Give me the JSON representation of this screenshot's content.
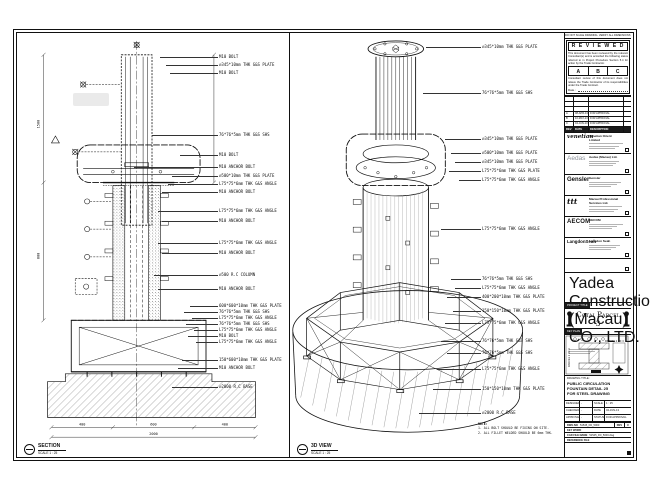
{
  "sheet": {
    "note_strip": "DO NOT SCALE DRAWING. VERIFY ALL DIMENSIONS ON SITE."
  },
  "section_view": {
    "title": "SECTION",
    "scale": "SCALE 1 : 25",
    "labels": [
      "M10 BOLT",
      "⌀345*10mm THK G&S PLATE",
      "M10 BOLT",
      "76*76*5mm THK G&S SHS",
      "M10 BOLT",
      "M10 ANCHOR BOLT",
      "⌀500*10mm THK G&S PLATE",
      "L75*75*6mm THK G&S ANGLE",
      "M10 ANCHOR BOLT",
      "L75*75*6mm THK G&S ANGLE",
      "M10 ANCHOR BOLT",
      "L75*75*6mm THK G&S ANGLE",
      "M10 ANCHOR BOLT",
      "⌀500 R.C COLUMN",
      "M10 ANCHOR BOLT",
      "600*600*10mm THK G&S PLATE",
      "76*76*5mm THK G&S SHS",
      "L75*75*6mm THK G&S ANGLE",
      "76*76*5mm THK G&S SHS",
      "L75*75*6mm THK G&S ANGLE",
      "M10 BOLT",
      "L75*75*6mm THK G&S ANGLE",
      "150*600*10mm THK G&S PLATE",
      "M10 ANCHOR BOLT",
      "⌀2000 R.C BASE"
    ],
    "dims": {
      "v1": "1500",
      "v2": "800",
      "b1": "400",
      "b2": "600",
      "b3": "400",
      "total": "2000"
    }
  },
  "iso_view": {
    "title": "3D VIEW",
    "scale": "SCALE 1 : 25",
    "labels": [
      "⌀345*10mm THK G&S PLATE",
      "76*76*5mm THK G&S SHS",
      "⌀345*10mm THK G&S PLATE",
      "⌀500*10mm THK G&S PLATE",
      "⌀345*10mm THK G&S PLATE",
      "L75*75*6mm THK G&S PLATE",
      "L75*75*6mm THK G&S ANGLE",
      "L75*75*6mm THK G&S ANGLE",
      "76*76*5mm THK G&S SHS",
      "L75*75*6mm THK G&S ANGLE",
      "400*200*10mm THK G&S PLATE",
      "150*150*10mm THK G&S PLATE",
      "L75*75*6mm THK G&S ANGLE",
      "76*76*5mm THK G&S SHS",
      "76*76*5mm THK G&S SHS",
      "L75*75*6mm THK G&S ANGLE",
      "150*150*10mm THK G&S PLATE",
      "⌀2000 R.C BASE"
    ],
    "note_heading": "NOTE:",
    "note_1": "1. ALL BOLT SHOULD BE FIXING ON SITE.",
    "note_2": "2. ALL FILLET WELDED SHOULD BE 6mm THK."
  },
  "titleblock": {
    "reviewed": {
      "heading": "R E V I E W E D",
      "para1": "This document has been reviewed by the relevant Consultant(s) and is accorded the following status referred to in Project Procedure Section 5.4 for action by the Trade Contractor.",
      "box_a": "A",
      "box_b": "B",
      "box_c": "C",
      "para2": "Consultant review of this document does not relieve the Trade Contractor of its responsibilities under the Trade Contract.",
      "date_label": "Date :"
    },
    "revisions": {
      "rows": [
        {
          "rev": "A",
          "date": "08-APR-13",
          "desc": "FOR APPROVAL"
        },
        {
          "rev": "B",
          "date": "10-MAY-13",
          "desc": "FOR APPROVAL"
        },
        {
          "rev": "C",
          "date": "04-JUN-13",
          "desc": "FOR APPROVAL"
        }
      ],
      "header": {
        "rev": "REV",
        "date": "DATE",
        "desc": "DESCRIPTION"
      }
    },
    "consultants": [
      {
        "logo": "venetian",
        "name": "Venetian Orient Limited"
      },
      {
        "logo": "Aedas",
        "name": "Aedas (Macau) Ltd."
      },
      {
        "logo": "Gensler",
        "name": "Gensler"
      },
      {
        "logo": "ttt",
        "name": "Macau Professional Services Ltd."
      },
      {
        "logo": "AECOM",
        "name": "AECOM"
      },
      {
        "logo": "LangdonSeah",
        "name": "Langdon Seah"
      }
    ],
    "contractor": {
      "name": "Yadea Construction (Macau) CO., LTD."
    },
    "project": {
      "tag": "PROJECT TITLE",
      "name": "Cotai Parcel 3"
    },
    "keyplan": {
      "tag": "KEY PLAN",
      "parcel_left": "PARCEL 1 OF 3",
      "parcel_top": "PARCEL 2 OF 3"
    },
    "drawing": {
      "title_label": "DRAWING TITLE:",
      "line1": "PUBLIC CIRCULATION",
      "line2": "FOUNTAIN DETAIL 25",
      "line3": "FOR STEEL DRAWING",
      "meta": {
        "designed_label": "DESIGNED",
        "designed": "-",
        "checked_label": "CHECKED",
        "checked": "-",
        "approved_label": "APPROVED",
        "approved": "-",
        "scale_label": "SCALE",
        "scale": "1 : 25",
        "date_label": "DATE",
        "date": "04-JUN-13",
        "status_label": "STATUS",
        "status": "FOR APPROVAL"
      },
      "dwg_no_label": "DWG NO",
      "dwg_no": "51545_FD_5000",
      "rev_label": "REV",
      "rev": "C",
      "keyword_label": "KEY WORD",
      "keyword": "",
      "cad_label": "CAD FILE NAME",
      "cad_file": "51545_FD_5000.dwg",
      "ref_label": "REFERENCE FILE",
      "ref_file": ""
    }
  }
}
